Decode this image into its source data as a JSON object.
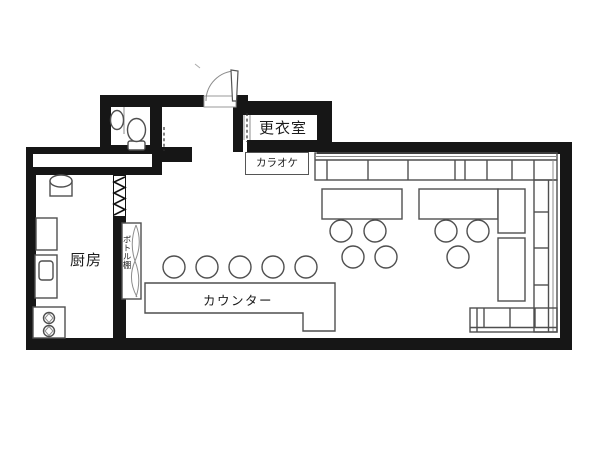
{
  "labels": {
    "changing_room": "更衣室",
    "karaoke": "カラオケ",
    "kitchen": "厨房",
    "bottle_shelf": "ボトル棚",
    "counter": "カウンター"
  },
  "colors": {
    "background": "#ffffff",
    "wall": "#161616",
    "furniture_line": "#4f4f4f",
    "light_line": "#8c8c8c",
    "text": "#1c1c1c"
  },
  "furniture_counts": {
    "counter_stools": 5,
    "table_chairs": 7,
    "dining_tables": 2,
    "side_tables": 2,
    "bench_runs": 3,
    "stove_burners": 2
  }
}
